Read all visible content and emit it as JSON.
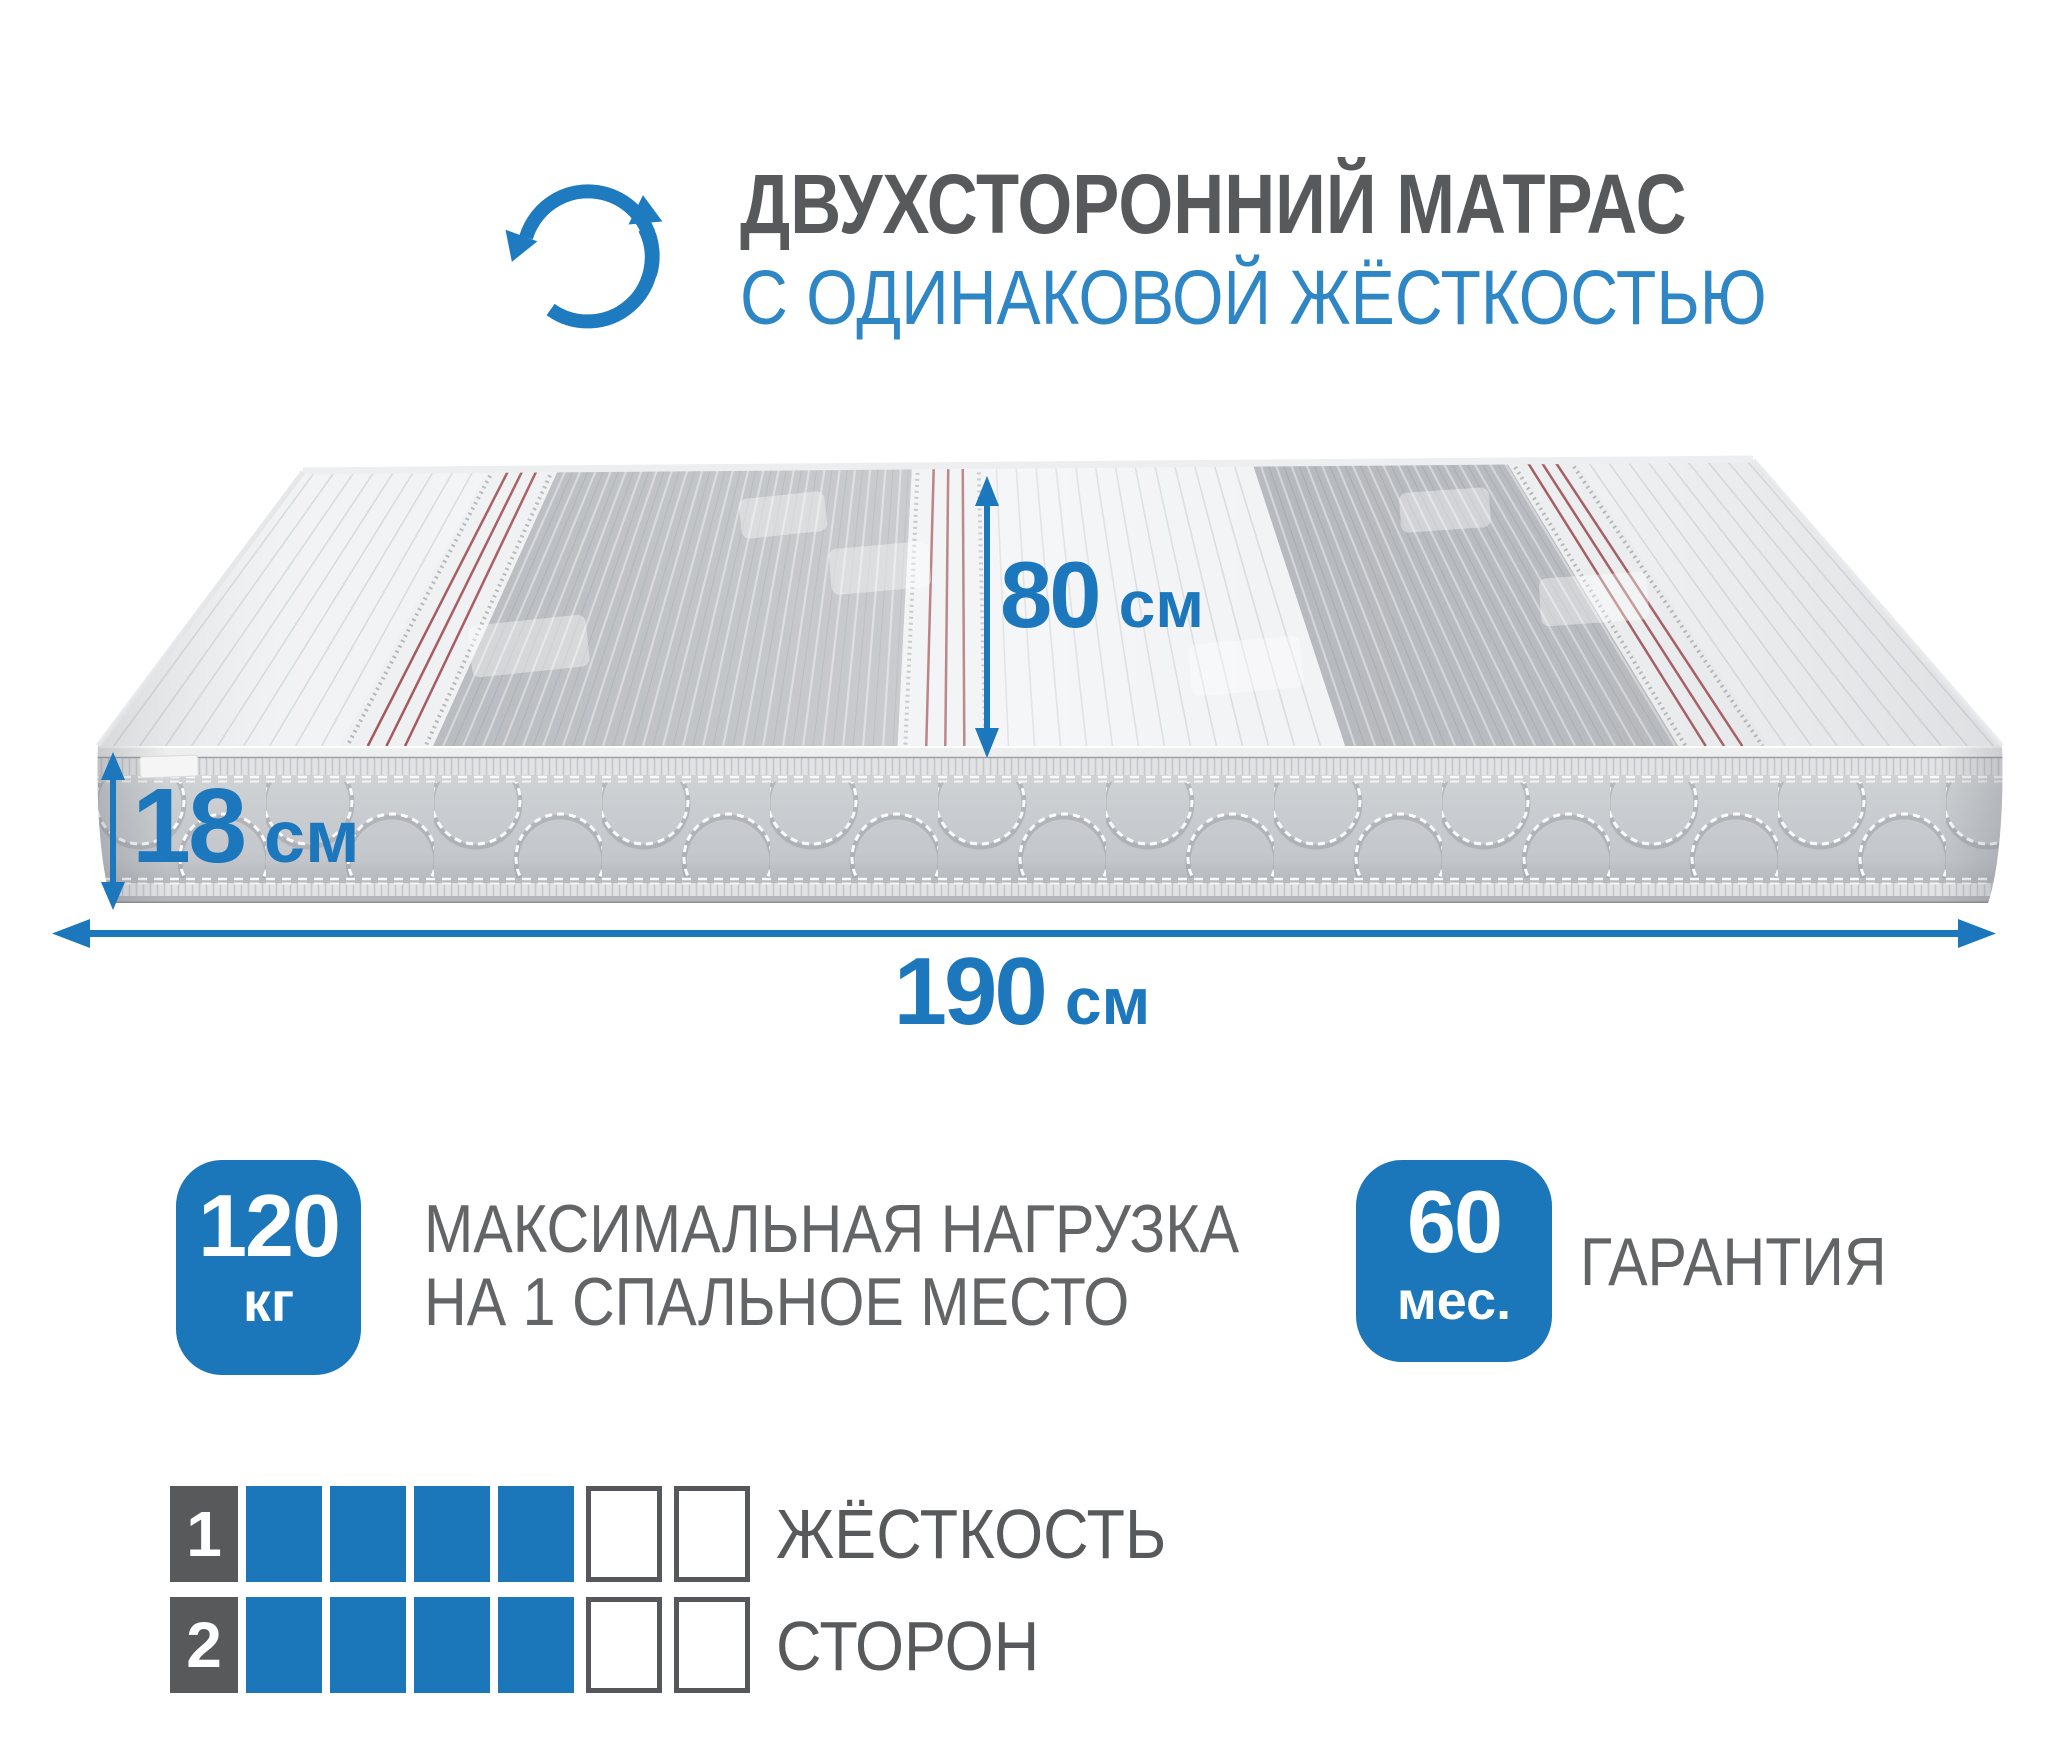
{
  "header": {
    "title": "ДВУХСТОРОННИЙ МАТРАС",
    "subtitle": "С ОДИНАКОВОЙ ЖЁСТКОСТЬЮ"
  },
  "dimensions": {
    "depth": {
      "value": "80",
      "unit": "см"
    },
    "height": {
      "value": "18",
      "unit": "см"
    },
    "length": {
      "value": "190",
      "unit": "см"
    }
  },
  "badges": {
    "max_load": {
      "value": "120",
      "unit": "кг",
      "caption_line1": "МАКСИМАЛЬНАЯ НАГРУЗКА",
      "caption_line2": "НА 1 СПАЛЬНОЕ МЕСТО"
    },
    "warranty": {
      "value": "60",
      "unit": "мес.",
      "caption": "ГАРАНТИЯ"
    }
  },
  "firmness_scale": {
    "rows": [
      {
        "number": "1",
        "filled": 4,
        "empty": 2
      },
      {
        "number": "2",
        "filled": 4,
        "empty": 2
      }
    ],
    "caption_line1": "ЖЁСТКОСТЬ",
    "caption_line2": "СТОРОН"
  },
  "colors": {
    "accent_blue": "#1b76ba",
    "subtitle_blue": "#2f86c5",
    "title_gray": "#58595b",
    "caption_gray": "#636466",
    "stripe_red": "#a3555a",
    "side_gray": "#c7cacd"
  }
}
